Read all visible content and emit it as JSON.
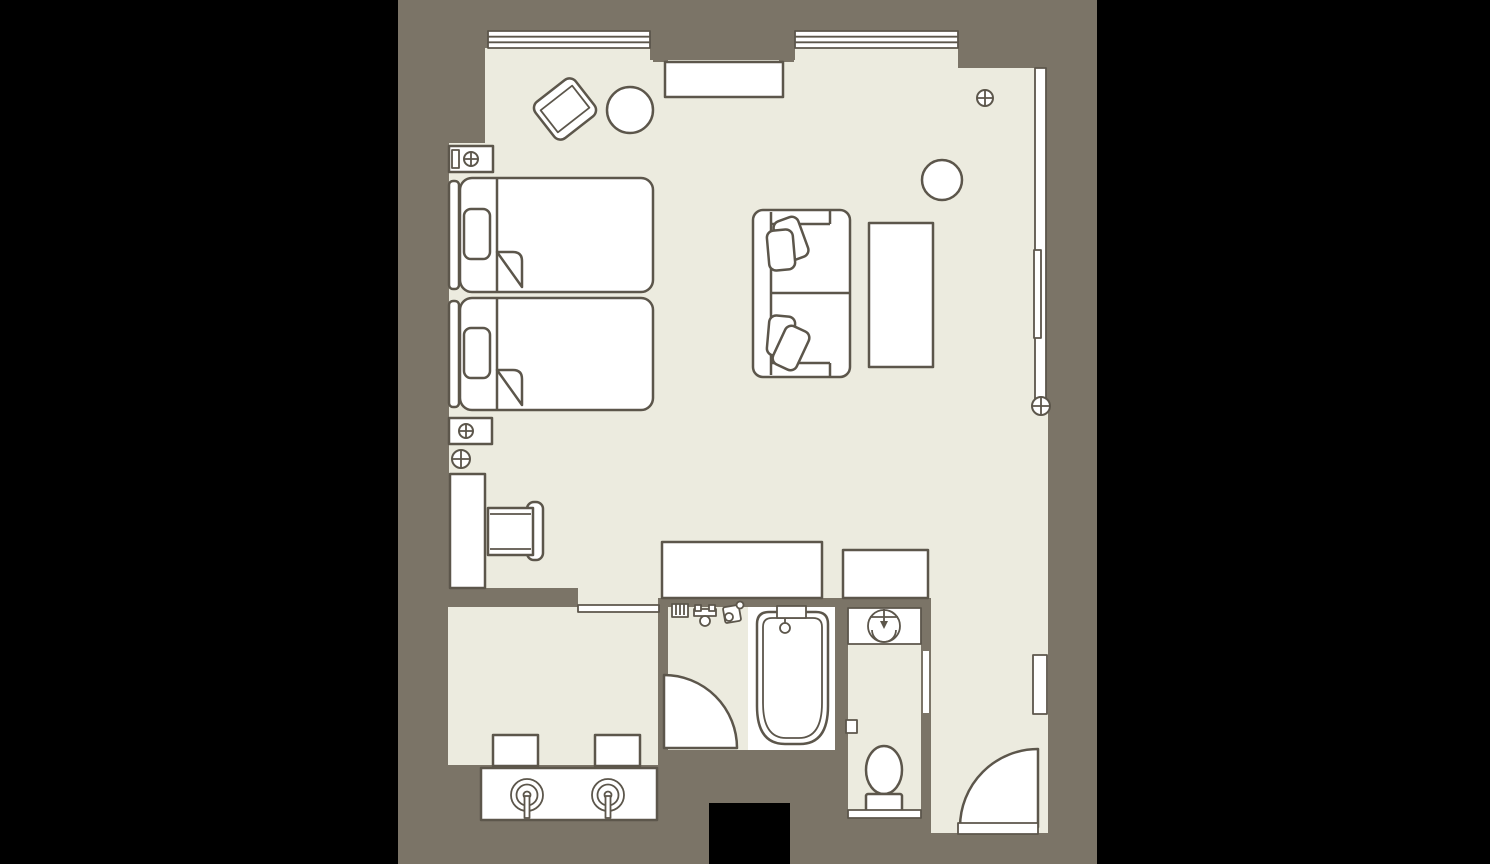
{
  "plan": {
    "title": "Hotel twin guest room floor plan",
    "rooms": [
      {
        "name": "bedroom-living-area",
        "fixtures": [
          "twin-bed-1",
          "twin-bed-2",
          "headboard-1",
          "headboard-2",
          "nightstand-1",
          "nightstand-2",
          "lounge-chair",
          "round-side-table-1",
          "round-side-table-2",
          "sofa",
          "sofa-cushions",
          "coffee-table",
          "console-cabinet",
          "desk",
          "desk-chair",
          "closet-1",
          "closet-2"
        ]
      },
      {
        "name": "dressing-area",
        "fixtures": [
          "vanity-counter",
          "sink-left",
          "sink-right",
          "stool-1",
          "stool-2",
          "pocket-door"
        ]
      },
      {
        "name": "bathroom",
        "fixtures": [
          "bathtub",
          "tub-faucet-deck",
          "shower-mixer",
          "towel-rack",
          "hand-shower",
          "bathroom-door"
        ]
      },
      {
        "name": "toilet-room",
        "fixtures": [
          "washbasin",
          "washbasin-counter",
          "toilet",
          "paper-holder",
          "toilet-threshold"
        ]
      },
      {
        "name": "entry-hall",
        "fixtures": [
          "entrance-door",
          "entry-threshold",
          "wall-niche-right",
          "wall-niche-left"
        ]
      }
    ],
    "windows": [
      "window-top-left",
      "window-top-right",
      "window-right-wall"
    ],
    "doors": {
      "swing_doors": 2,
      "pocket_doors": 1
    },
    "ceiling_light_symbols": 5
  },
  "palette": {
    "background": "#000000",
    "wall": "#7b7467",
    "floor": "#ecebdf",
    "line": "#5c564b",
    "fixture": "#ffffff"
  }
}
